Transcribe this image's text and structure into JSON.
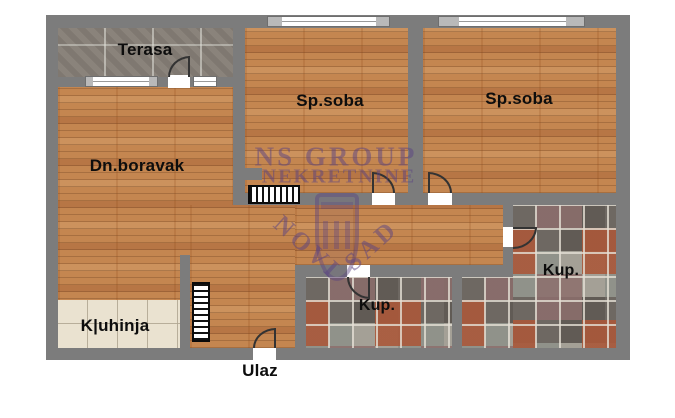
{
  "plan": {
    "type": "apartment-floor-plan",
    "rooms": [
      {
        "name": "terasa",
        "label": "Terasa"
      },
      {
        "name": "sp-soba-1",
        "label": "Sp.soba"
      },
      {
        "name": "sp-soba-2",
        "label": "Sp.soba"
      },
      {
        "name": "dn-boravak",
        "label": "Dn.boravak"
      },
      {
        "name": "kuhinja",
        "label": "K|uhinja"
      },
      {
        "name": "kup-1",
        "label": "Kup."
      },
      {
        "name": "kup-2",
        "label": "Kup."
      },
      {
        "name": "ulaz",
        "label": "Ulaz"
      }
    ],
    "watermark": {
      "brand": "NS GROUP",
      "brand2": "NEKRETNINE",
      "city_word1": "NOVI",
      "city_word2": "SAD"
    },
    "colors": {
      "wall": "#7c7c7c",
      "wood": "#c48650",
      "terrace_tile": "#8a837b",
      "kitchen_tile": "#eae2d0",
      "bath_dark": "#615b55",
      "bath_light": "#a4a096",
      "bath_terracotta": "#aa583a",
      "bath_mauve": "#8d6e6c",
      "watermark": "#5a4182"
    }
  }
}
